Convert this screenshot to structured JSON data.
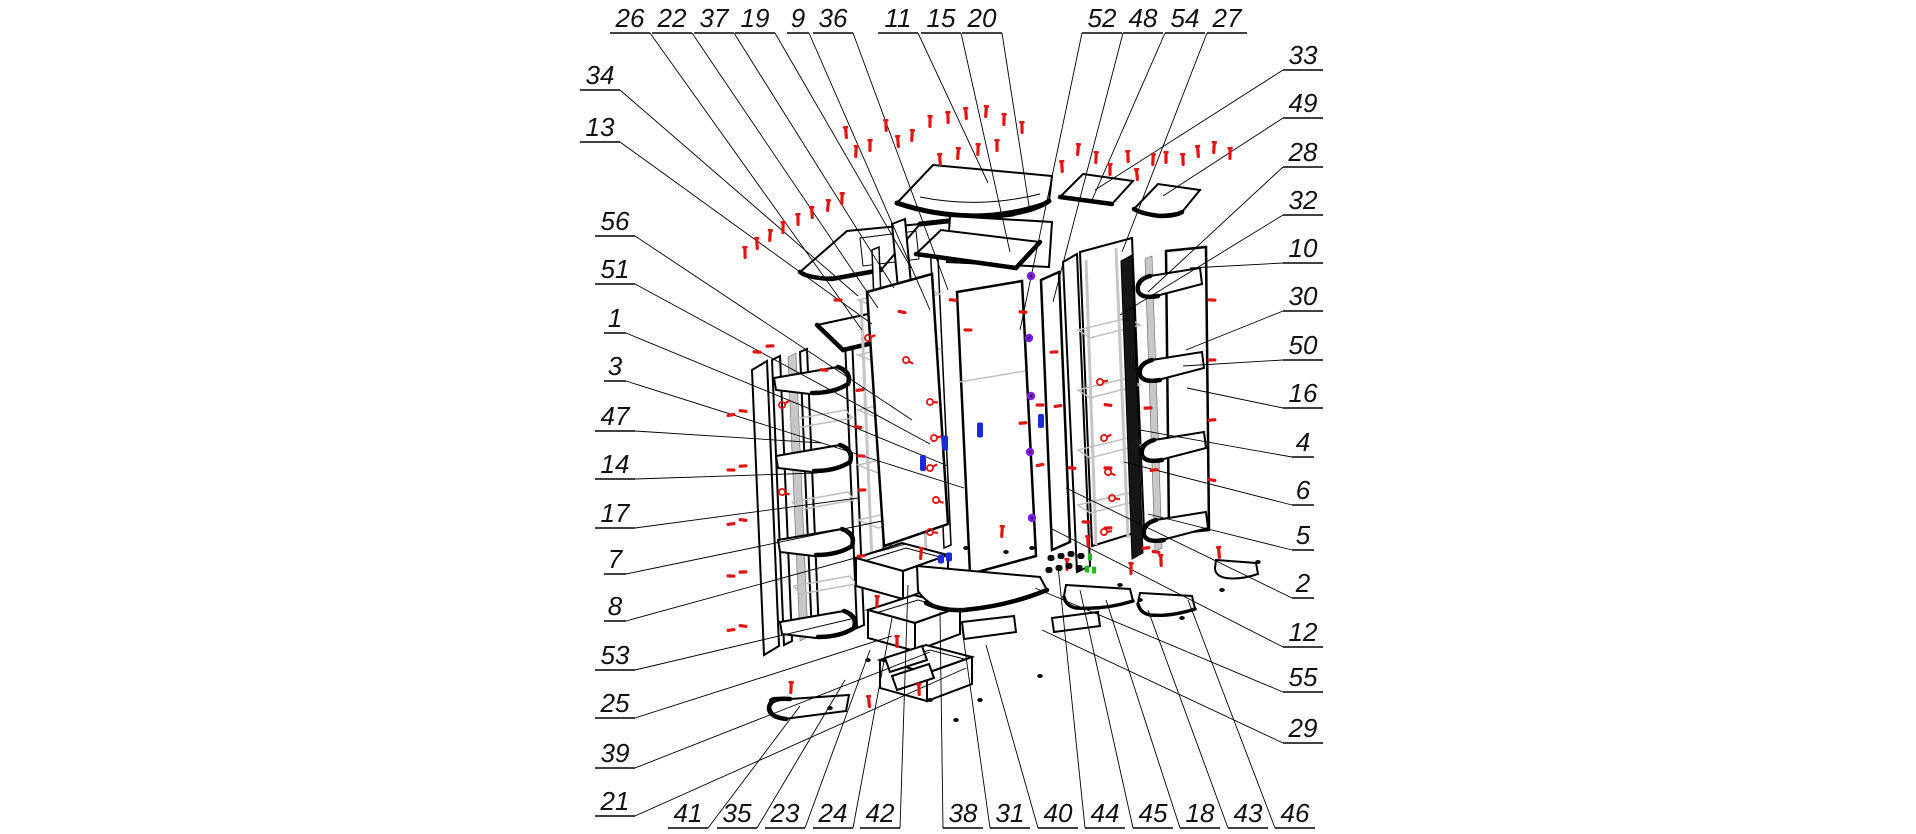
{
  "diagram": {
    "type": "exploded-assembly-diagram",
    "subject": "corner wardrobe cabinet with shelves, doors and drawers",
    "background": "#ffffff"
  },
  "colors": {
    "line": "#000000",
    "ghost_gray": "#bfbfbf",
    "panel_gray": "#c8c8c8",
    "fastener_red": "#e01410",
    "cam_purple": "#7b1fe0",
    "handle_blue": "#1c2bd8",
    "fitting_green": "#21b821"
  },
  "callouts": [
    {
      "n": 26,
      "lx": 630,
      "ly": 33,
      "tx": 862,
      "ty": 330
    },
    {
      "n": 22,
      "lx": 672,
      "ly": 33,
      "tx": 878,
      "ty": 308
    },
    {
      "n": 37,
      "lx": 714,
      "ly": 33,
      "tx": 894,
      "ty": 288
    },
    {
      "n": 19,
      "lx": 755,
      "ly": 33,
      "tx": 911,
      "ty": 268
    },
    {
      "n": 9,
      "lx": 798,
      "ly": 33,
      "tx": 930,
      "ty": 310
    },
    {
      "n": 36,
      "lx": 833,
      "ly": 33,
      "tx": 948,
      "ty": 290
    },
    {
      "n": 11,
      "lx": 898,
      "ly": 33,
      "tx": 988,
      "ty": 183
    },
    {
      "n": 15,
      "lx": 941,
      "ly": 33,
      "tx": 1010,
      "ty": 252
    },
    {
      "n": 20,
      "lx": 982,
      "ly": 33,
      "tx": 1030,
      "ty": 212
    },
    {
      "n": 52,
      "lx": 1102,
      "ly": 33,
      "tx": 1020,
      "ty": 330
    },
    {
      "n": 48,
      "lx": 1143,
      "ly": 33,
      "tx": 1053,
      "ty": 302
    },
    {
      "n": 54,
      "lx": 1185,
      "ly": 33,
      "tx": 1092,
      "ty": 200
    },
    {
      "n": 27,
      "lx": 1227,
      "ly": 33,
      "tx": 1122,
      "ty": 252
    },
    {
      "n": 34,
      "lx": 600,
      "ly": 90,
      "tx": 858,
      "ty": 296
    },
    {
      "n": 13,
      "lx": 600,
      "ly": 142,
      "tx": 872,
      "ty": 324
    },
    {
      "n": 56,
      "lx": 615,
      "ly": 236,
      "tx": 912,
      "ty": 420
    },
    {
      "n": 51,
      "lx": 615,
      "ly": 284,
      "tx": 930,
      "ty": 444
    },
    {
      "n": 1,
      "lx": 615,
      "ly": 333,
      "tx": 948,
      "ty": 466
    },
    {
      "n": 3,
      "lx": 615,
      "ly": 381,
      "tx": 964,
      "ty": 488
    },
    {
      "n": 47,
      "lx": 615,
      "ly": 431,
      "tx": 822,
      "ty": 443
    },
    {
      "n": 14,
      "lx": 615,
      "ly": 479,
      "tx": 817,
      "ty": 473
    },
    {
      "n": 17,
      "lx": 615,
      "ly": 528,
      "tx": 858,
      "ty": 498
    },
    {
      "n": 7,
      "lx": 615,
      "ly": 574,
      "tx": 882,
      "ty": 521
    },
    {
      "n": 8,
      "lx": 615,
      "ly": 621,
      "tx": 906,
      "ty": 544
    },
    {
      "n": 53,
      "lx": 615,
      "ly": 670,
      "tx": 855,
      "ty": 618
    },
    {
      "n": 25,
      "lx": 615,
      "ly": 718,
      "tx": 892,
      "ty": 636
    },
    {
      "n": 39,
      "lx": 615,
      "ly": 768,
      "tx": 930,
      "ty": 652
    },
    {
      "n": 21,
      "lx": 615,
      "ly": 816,
      "tx": 966,
      "ty": 668
    },
    {
      "n": 33,
      "lx": 1303,
      "ly": 70,
      "tx": 1095,
      "ty": 190
    },
    {
      "n": 49,
      "lx": 1303,
      "ly": 118,
      "tx": 1163,
      "ty": 196
    },
    {
      "n": 28,
      "lx": 1303,
      "ly": 167,
      "tx": 1148,
      "ty": 292
    },
    {
      "n": 32,
      "lx": 1303,
      "ly": 215,
      "tx": 1120,
      "ty": 315
    },
    {
      "n": 10,
      "lx": 1303,
      "ly": 263,
      "tx": 1190,
      "ty": 268
    },
    {
      "n": 30,
      "lx": 1303,
      "ly": 311,
      "tx": 1186,
      "ty": 350
    },
    {
      "n": 50,
      "lx": 1303,
      "ly": 360,
      "tx": 1183,
      "ty": 366
    },
    {
      "n": 16,
      "lx": 1303,
      "ly": 408,
      "tx": 1187,
      "ty": 388
    },
    {
      "n": 4,
      "lx": 1303,
      "ly": 457,
      "tx": 1140,
      "ty": 430
    },
    {
      "n": 6,
      "lx": 1303,
      "ly": 505,
      "tx": 1124,
      "ty": 462
    },
    {
      "n": 5,
      "lx": 1303,
      "ly": 550,
      "tx": 1148,
      "ty": 514
    },
    {
      "n": 2,
      "lx": 1303,
      "ly": 598,
      "tx": 1066,
      "ty": 488
    },
    {
      "n": 12,
      "lx": 1303,
      "ly": 647,
      "tx": 1050,
      "ty": 528
    },
    {
      "n": 55,
      "lx": 1303,
      "ly": 692,
      "tx": 1035,
      "ty": 588
    },
    {
      "n": 29,
      "lx": 1303,
      "ly": 743,
      "tx": 1042,
      "ty": 630
    },
    {
      "n": 41,
      "lx": 688,
      "ly": 828,
      "tx": 800,
      "ty": 706
    },
    {
      "n": 35,
      "lx": 737,
      "ly": 828,
      "tx": 845,
      "ty": 680
    },
    {
      "n": 23,
      "lx": 785,
      "ly": 828,
      "tx": 870,
      "ty": 650
    },
    {
      "n": 24,
      "lx": 833,
      "ly": 828,
      "tx": 892,
      "ty": 618
    },
    {
      "n": 42,
      "lx": 880,
      "ly": 828,
      "tx": 908,
      "ty": 585
    },
    {
      "n": 38,
      "lx": 963,
      "ly": 828,
      "tx": 940,
      "ty": 612
    },
    {
      "n": 31,
      "lx": 1010,
      "ly": 828,
      "tx": 962,
      "ty": 628
    },
    {
      "n": 40,
      "lx": 1058,
      "ly": 828,
      "tx": 986,
      "ty": 645
    },
    {
      "n": 44,
      "lx": 1105,
      "ly": 828,
      "tx": 1058,
      "ty": 566
    },
    {
      "n": 45,
      "lx": 1153,
      "ly": 828,
      "tx": 1080,
      "ty": 590
    },
    {
      "n": 18,
      "lx": 1200,
      "ly": 828,
      "tx": 1106,
      "ty": 600
    },
    {
      "n": 43,
      "lx": 1248,
      "ly": 828,
      "tx": 1148,
      "ty": 610
    },
    {
      "n": 46,
      "lx": 1295,
      "ly": 828,
      "tx": 1188,
      "ty": 600
    }
  ],
  "fasteners": {
    "screws_vertical": [
      [
        846,
        133
      ],
      [
        856,
        152
      ],
      [
        870,
        146
      ],
      [
        886,
        126
      ],
      [
        898,
        142
      ],
      [
        912,
        136
      ],
      [
        930,
        122
      ],
      [
        948,
        118
      ],
      [
        966,
        114
      ],
      [
        986,
        112
      ],
      [
        1004,
        120
      ],
      [
        1022,
        128
      ],
      [
        940,
        160
      ],
      [
        958,
        154
      ],
      [
        978,
        150
      ],
      [
        997,
        146
      ],
      [
        1062,
        167
      ],
      [
        1078,
        150
      ],
      [
        1096,
        158
      ],
      [
        1110,
        170
      ],
      [
        1128,
        157
      ],
      [
        1137,
        175
      ],
      [
        1153,
        160
      ],
      [
        1166,
        158
      ],
      [
        1183,
        160
      ],
      [
        1198,
        152
      ],
      [
        1214,
        148
      ],
      [
        1230,
        154
      ],
      [
        745,
        253
      ],
      [
        757,
        244
      ],
      [
        770,
        236
      ],
      [
        783,
        228
      ],
      [
        798,
        220
      ],
      [
        812,
        213
      ],
      [
        828,
        206
      ],
      [
        842,
        199
      ],
      [
        1067,
        565
      ],
      [
        1088,
        542
      ],
      [
        921,
        554
      ],
      [
        877,
        602
      ],
      [
        897,
        642
      ],
      [
        919,
        690
      ],
      [
        869,
        702
      ],
      [
        791,
        688
      ],
      [
        1131,
        569
      ],
      [
        1161,
        561
      ],
      [
        1219,
        553
      ],
      [
        1002,
        532
      ]
    ],
    "bolts_horizontal": [
      [
        731,
        415
      ],
      [
        743,
        411
      ],
      [
        731,
        470
      ],
      [
        743,
        466
      ],
      [
        731,
        524
      ],
      [
        743,
        520
      ],
      [
        731,
        576
      ],
      [
        743,
        572
      ],
      [
        731,
        630
      ],
      [
        743,
        626
      ],
      [
        757,
        352
      ],
      [
        770,
        346
      ],
      [
        860,
        390
      ],
      [
        858,
        427
      ],
      [
        861,
        456
      ],
      [
        862,
        490
      ],
      [
        861,
        556
      ],
      [
        902,
        312
      ],
      [
        1023,
        312
      ],
      [
        1040,
        405
      ],
      [
        1023,
        423
      ],
      [
        1040,
        465
      ],
      [
        953,
        300
      ],
      [
        968,
        330
      ],
      [
        1054,
        352
      ],
      [
        1058,
        406
      ],
      [
        1072,
        468
      ],
      [
        1086,
        522
      ],
      [
        1148,
        408
      ],
      [
        1154,
        470
      ],
      [
        1108,
        405
      ],
      [
        1108,
        468
      ],
      [
        1108,
        528
      ],
      [
        1146,
        548
      ],
      [
        1156,
        552
      ],
      [
        1212,
        300
      ],
      [
        1212,
        360
      ],
      [
        1212,
        420
      ],
      [
        1212,
        480
      ],
      [
        824,
        370
      ],
      [
        838,
        300
      ]
    ],
    "cam_screws": [
      [
        782,
        405
      ],
      [
        782,
        492
      ],
      [
        930,
        402
      ],
      [
        934,
        438
      ],
      [
        930,
        468
      ],
      [
        936,
        500
      ],
      [
        930,
        532
      ],
      [
        1100,
        382
      ],
      [
        1104,
        438
      ],
      [
        1108,
        472
      ],
      [
        1112,
        498
      ],
      [
        1104,
        532
      ],
      [
        868,
        338
      ],
      [
        906,
        360
      ]
    ],
    "purple_cams": [
      [
        1031,
        276
      ],
      [
        1029,
        338
      ],
      [
        1031,
        396
      ],
      [
        1030,
        452
      ],
      [
        1032,
        518
      ]
    ],
    "blue_handles": [
      [
        923,
        463,
        16
      ],
      [
        945,
        443,
        15
      ],
      [
        980,
        430,
        15
      ],
      [
        1041,
        421,
        14
      ],
      [
        941,
        559,
        9
      ],
      [
        949,
        557,
        9
      ]
    ],
    "green_fittings": [
      [
        1090,
        557
      ],
      [
        1087,
        569
      ],
      [
        1094,
        570
      ]
    ],
    "hardware_dots": [
      [
        1051,
        558
      ],
      [
        1061,
        556
      ],
      [
        1071,
        554
      ],
      [
        1081,
        556
      ],
      [
        1049,
        570
      ],
      [
        1059,
        568
      ],
      [
        1069,
        566
      ],
      [
        1079,
        568
      ]
    ],
    "debris_dots": [
      [
        966,
        548
      ],
      [
        1006,
        552
      ],
      [
        1032,
        548
      ],
      [
        1120,
        585
      ],
      [
        1182,
        618
      ],
      [
        930,
        700
      ],
      [
        956,
        720
      ],
      [
        868,
        660
      ],
      [
        830,
        708
      ],
      [
        1222,
        590
      ],
      [
        1258,
        562
      ],
      [
        1140,
        600
      ],
      [
        980,
        700
      ],
      [
        1040,
        676
      ]
    ]
  }
}
